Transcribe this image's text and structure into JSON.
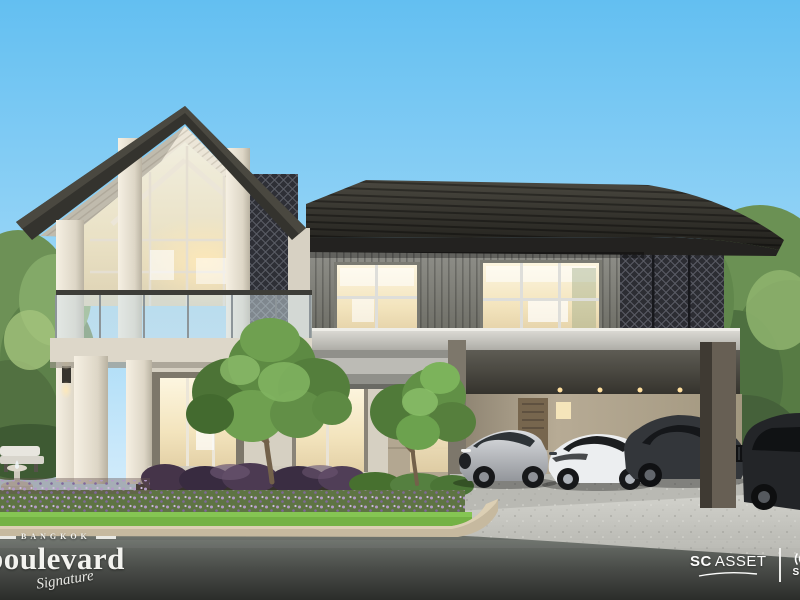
{
  "image": {
    "description": "Dusk architectural rendering of a two-storey luxury house with a steep glazed gable wing, dark hip-roof wing with lattice screens, a carport with four cars, landscaped garden with purple flower beds and two front trees",
    "cars": [
      "silver sports coupe",
      "white sports car with black roof",
      "dark grey SUV",
      "dark SUV partially cropped at right edge"
    ]
  },
  "branding": {
    "project_logo": {
      "city": "BANGKOK",
      "name": "boulevard",
      "tagline": "Signature"
    },
    "developer_logo": {
      "prefix": "SC",
      "suffix": "ASSET"
    },
    "partner_logo": {
      "text": "SCAS"
    }
  },
  "palette": {
    "sky_top": "#63bff1",
    "sky_horizon": "#e9f4fc",
    "roof_dark": "#2e2d29",
    "wall_cream": "#e9e3d6",
    "wall_slat_grey": "#84847c",
    "window_glow": "#f7ecd0",
    "lattice_dark": "#2c2d33",
    "foliage_green": "#5f8f4a",
    "flower_purple": "#9a7fae",
    "driveway_concrete": "#c5c5bf",
    "road_asphalt": "#3c3f3c",
    "logo_text": "#f3f3ef"
  }
}
